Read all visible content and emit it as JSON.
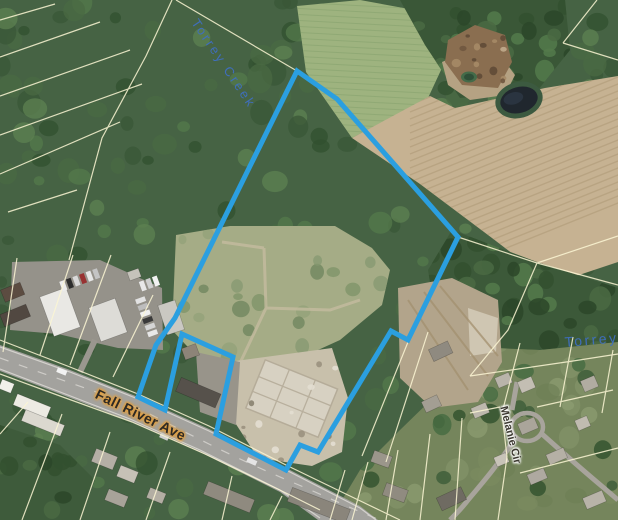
{
  "map": {
    "labels": {
      "creek": "Torrey Creek",
      "creek_right": "Torrey",
      "main_road": "Fall River Ave",
      "side_road": "Melanie Cir"
    },
    "colors": {
      "boundary": "#2b9fe0",
      "water_label": "#3f6fc1",
      "road_label": "#2e2a24",
      "road_label_glow": "#dfa045",
      "parcel_line": "#fbf6d4"
    },
    "boundary": {
      "points": "297,71 337,99 458,237 408,340 391,331 318,452 300,445 286,470 216,434 233,357 182,334 165,410 138,397 156,345 175,318",
      "stroke_width": 5
    }
  }
}
